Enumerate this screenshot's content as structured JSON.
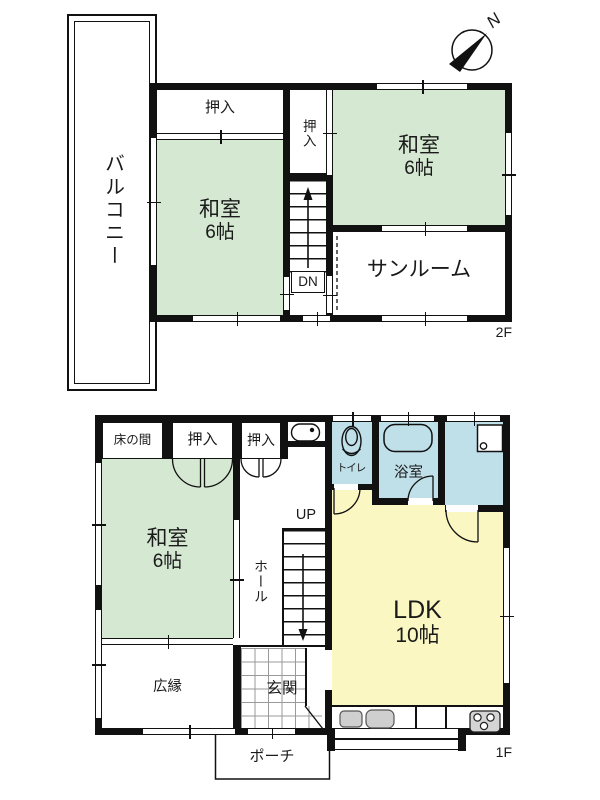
{
  "colors": {
    "room_green": "#d5e8d2",
    "room_blue": "#bfdfe9",
    "room_yellow": "#fbf7c3",
    "wall": "#111111"
  },
  "compass": {
    "north_label": "N"
  },
  "floor2": {
    "floor_label": "2F",
    "balcony_label": "バルコニー",
    "closet_top_label": "押入",
    "closet_side_label": "押入",
    "washitsu_left": {
      "name": "和室",
      "size": "6帖"
    },
    "washitsu_right": {
      "name": "和室",
      "size": "6帖"
    },
    "sunroom_label": "サンルーム",
    "stairs_label": "DN"
  },
  "floor1": {
    "floor_label": "1F",
    "tokonoma_label": "床の間",
    "closet1_label": "押入",
    "closet2_label": "押入",
    "toilet_label": "トイレ",
    "bath_label": "浴室",
    "washitsu": {
      "name": "和室",
      "size": "6帖"
    },
    "hall_label": "ホール",
    "stairs_label": "UP",
    "ldk": {
      "name": "LDK",
      "size": "10帖"
    },
    "hiroen_label": "広縁",
    "genkan_label": "玄関",
    "porch_label": "ポーチ"
  }
}
